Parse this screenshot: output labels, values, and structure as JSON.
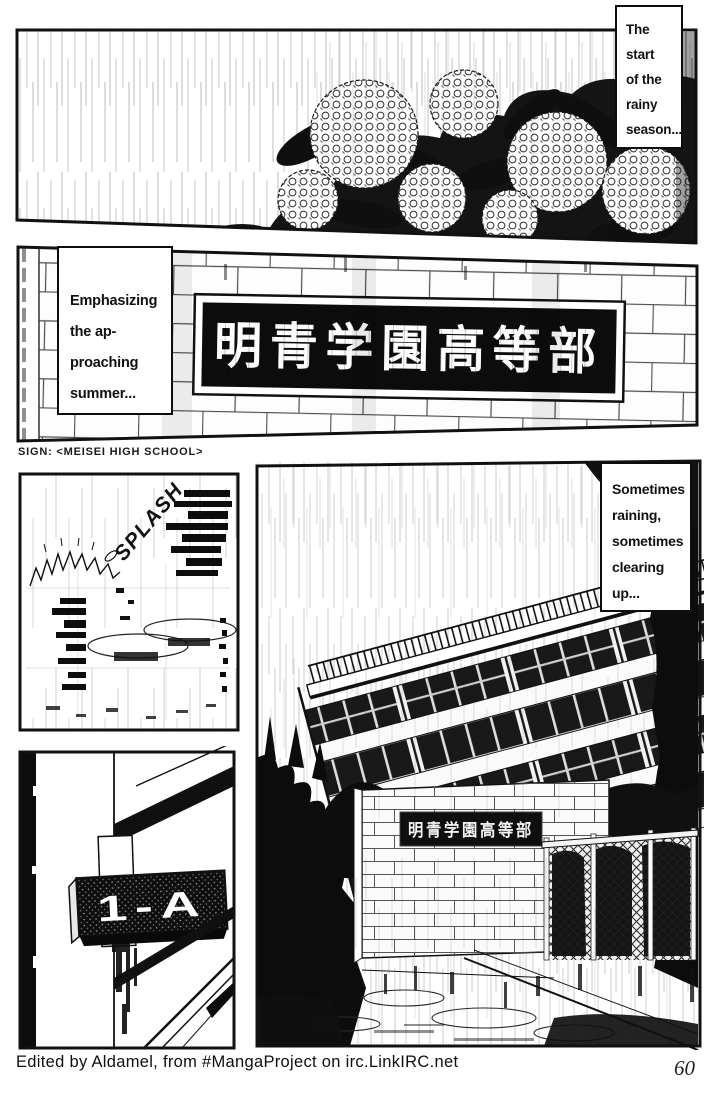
{
  "page": {
    "number": "60",
    "credit": "Edited by Aldamel, from #MangaProject on irc.LinkIRC.net"
  },
  "captions": {
    "start_of_rainy_season": {
      "lines": [
        "The",
        "start",
        "of the",
        "rainy",
        "season..."
      ]
    },
    "approaching_summer": {
      "lines": [
        "Emphasizing",
        "the ap-",
        "proaching",
        "summer..."
      ]
    },
    "sometimes_raining": {
      "lines": [
        "Sometimes",
        "raining,",
        "sometimes",
        "clearing",
        "up..."
      ]
    }
  },
  "translator_note": "SIGN: <MEISEI HIGH SCHOOL>",
  "signs": {
    "school_gate_sign": "明青学園高等部",
    "school_wall_sign": "明青学園高等部",
    "classroom_door_sign": "1-A"
  },
  "sfx": {
    "splash": "SPLASH"
  },
  "colors": {
    "ink": "#111111",
    "paper": "#ffffff"
  }
}
